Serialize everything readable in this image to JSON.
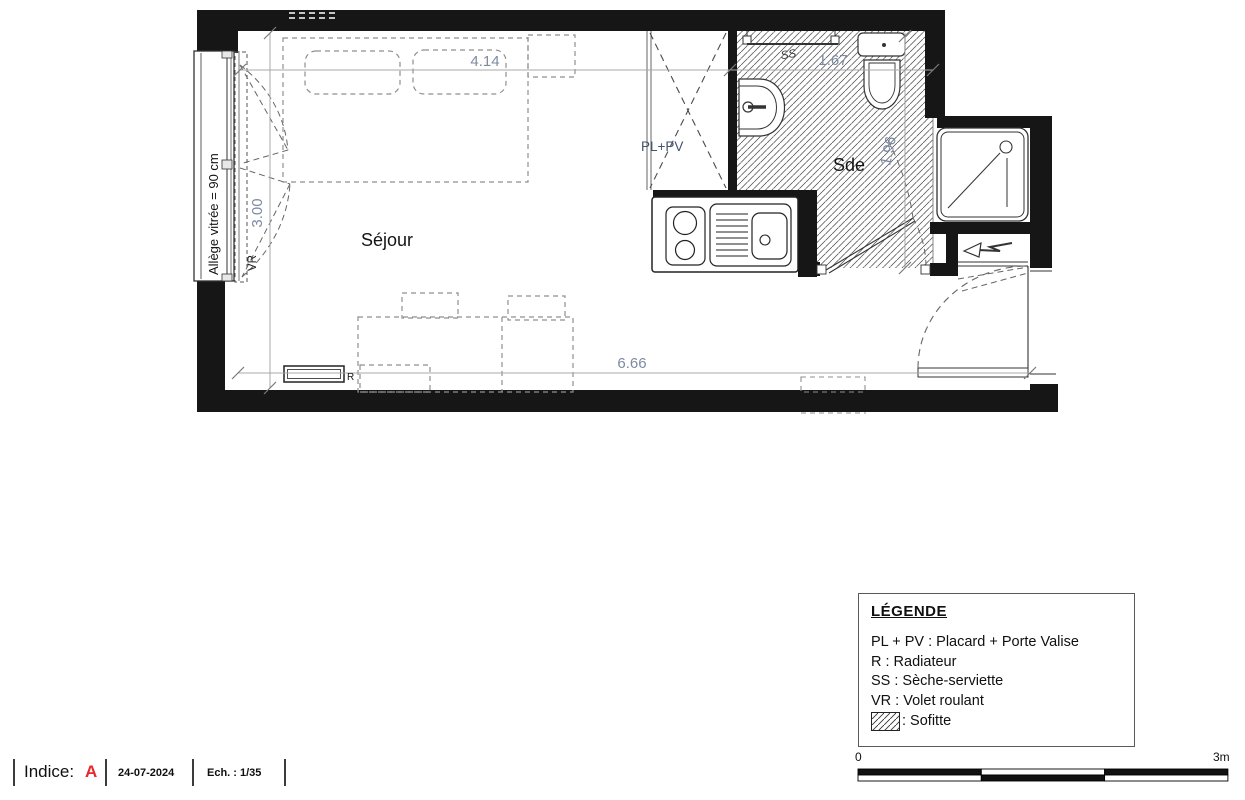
{
  "plan": {
    "rooms": {
      "sejour": "Séjour",
      "sde": "Sde"
    },
    "labels": {
      "pl_pv": "PL+PV",
      "ss": "SS",
      "vr": "VR",
      "radiator": "R",
      "allege": "Allège vitrée = 90 cm"
    },
    "dimensions": {
      "sejour_width": "4.14",
      "sde_width": "1.67",
      "sejour_height": "3.00",
      "sde_height": "1.96",
      "total_width": "6.66"
    }
  },
  "legend": {
    "title": "LÉGENDE",
    "items": [
      "PL + PV : Placard + Porte Valise",
      "R : Radiateur",
      "SS : Sèche-serviette",
      "VR : Volet roulant"
    ],
    "sofitte": ": Sofitte"
  },
  "title_block": {
    "indice_label": "Indice:",
    "indice_value": "A",
    "date": "24-07-2024",
    "scale": "Ech. : 1/35"
  },
  "scale_bar": {
    "start": "0",
    "end": "3m"
  },
  "colors": {
    "wall": "#161616",
    "dim": "#7d8aa2",
    "red": "#e8282e"
  }
}
